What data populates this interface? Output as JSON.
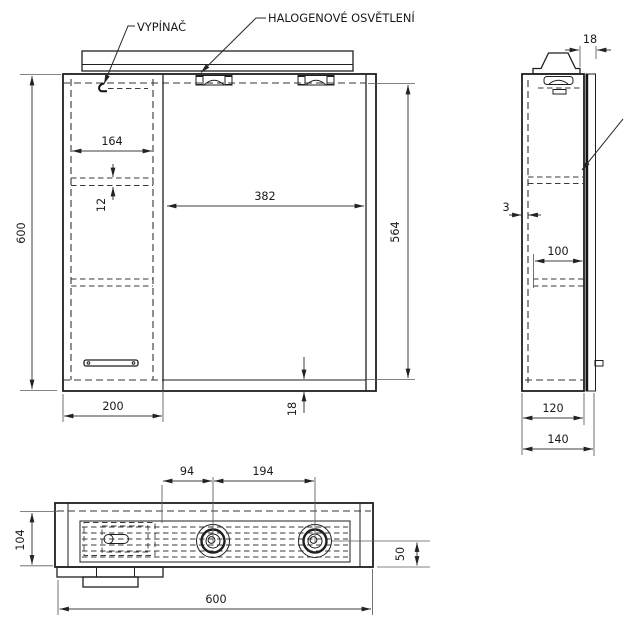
{
  "drawing": {
    "labels": {
      "switch": "VYPÍNAČ",
      "halogen_light": "HALOGENOVÉ OSVĚTLENÍ"
    },
    "dimensions": {
      "front": {
        "total_height": "600",
        "shelf_width": "164",
        "shelf_thickness": "12",
        "mirror_width": "382",
        "mirror_height": "564",
        "cabinet_width": "200",
        "bottom_panel_thickness": "18"
      },
      "side": {
        "top_panel_thickness": "18",
        "back_clearance": "3",
        "shelf_depth": "100",
        "body_depth": "120",
        "total_depth": "140"
      },
      "plan": {
        "lamp_edge_offset": "94",
        "lamp_spacing": "194",
        "body_depth": "104",
        "lamp_inset": "50",
        "total_width": "600"
      }
    },
    "colors": {
      "line": "#1f1f1f",
      "dimension_line": "#3c3c3c",
      "background": "#ffffff"
    }
  }
}
